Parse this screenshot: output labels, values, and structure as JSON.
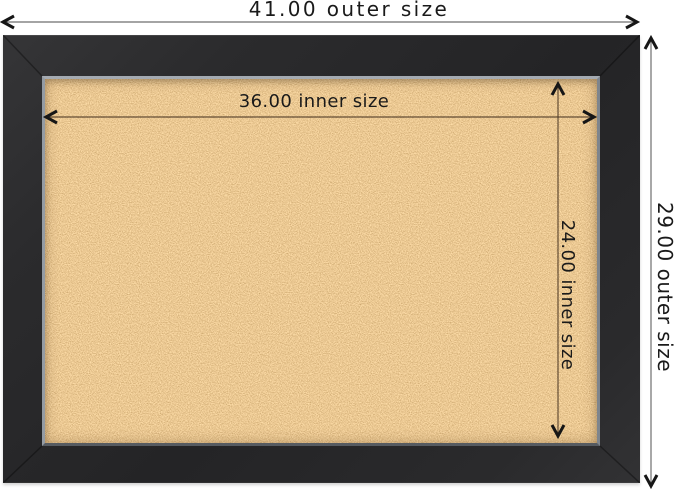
{
  "image": {
    "description": "Framed cork bulletin board product diagram with outer and inner dimension annotations",
    "background_color": "#ffffff"
  },
  "annotations": {
    "outer_width": "41.00 outer size",
    "outer_height": "29.00 outer size",
    "inner_width": "36.00 inner size",
    "inner_height": "24.00 inner size"
  },
  "dimensions_shown": {
    "outer_width_value": 41.0,
    "outer_height_value": 29.0,
    "inner_width_value": 36.0,
    "inner_height_value": 24.0
  },
  "board": {
    "frame_color": "#29292b",
    "frame_lip_color": "#8d949c",
    "cork_color": "#d4974d",
    "dimension_line_color": "#6e6e6e",
    "arrowhead_color": "#161616",
    "label_color": "#1a1a1a"
  },
  "icons": {
    "arrow_left": "chevron-left",
    "arrow_right": "chevron-right",
    "arrow_up": "chevron-up",
    "arrow_down": "chevron-down"
  }
}
